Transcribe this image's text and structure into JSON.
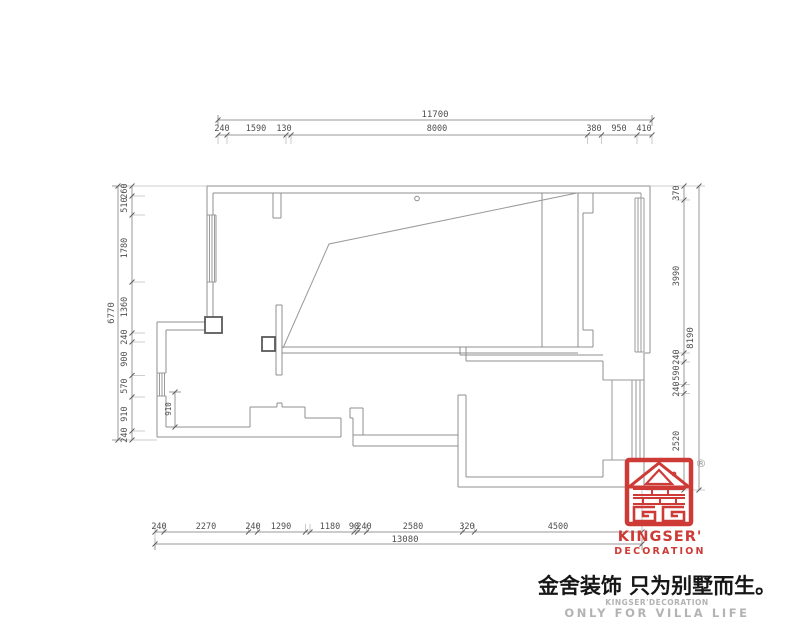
{
  "dims": {
    "top": {
      "overall": "11700",
      "segments": [
        "240",
        "1590",
        "130",
        "8000",
        "380",
        "950",
        "410"
      ]
    },
    "bottom": {
      "overall": "13080",
      "segments": [
        "240",
        "2270",
        "240",
        "1290",
        "1180",
        "90",
        "240",
        "2580",
        "320",
        "4500"
      ]
    },
    "left": {
      "overall": "6770",
      "segments": [
        "260",
        "510",
        "1780",
        "1360",
        "240",
        "900",
        "570",
        "910",
        "240"
      ]
    },
    "right": {
      "overall": "8190",
      "segments": [
        "370",
        "3990",
        "240",
        "590",
        "240",
        "2520"
      ]
    },
    "interior": {
      "value": "910"
    }
  },
  "branding": {
    "registered_mark": "®",
    "name": "KINGSER'",
    "subtitle": "DECORATION",
    "slogan_cn": "金舍装饰 只为别墅而生。",
    "slogan_en_line1": "KINGSER'DECORATION",
    "slogan_en_line2": "ONLY FOR VILLA LIFE"
  },
  "colors": {
    "brand_red": "#ce3a36",
    "wall_gray": "#8f8f8f",
    "dim_line_gray": "#9a9a9a",
    "dim_text_gray": "#4f4f4f",
    "muted_text_gray": "#b3b3b3"
  }
}
